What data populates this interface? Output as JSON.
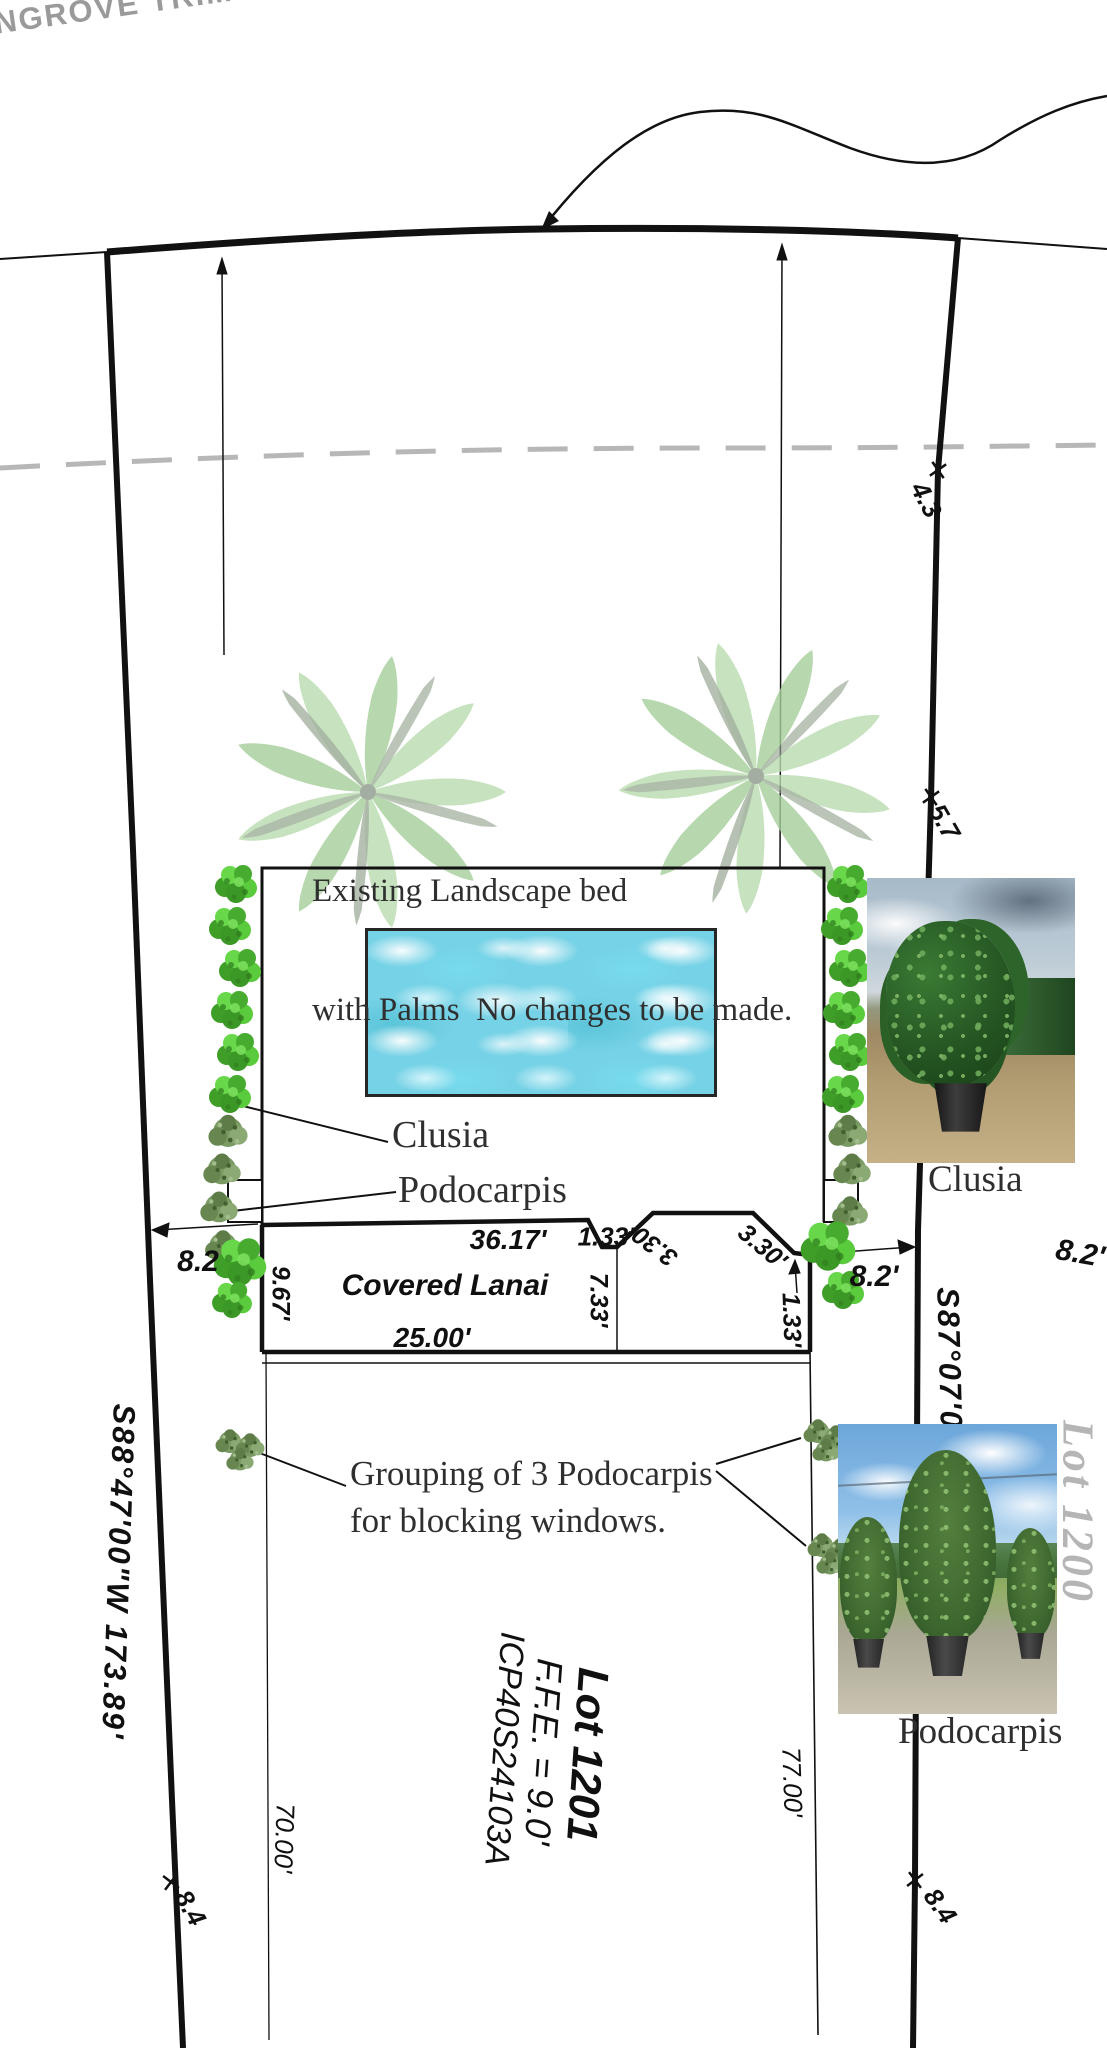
{
  "note": "NGROVE TRIMMING)",
  "annotations": {
    "bed1": "Existing Landscape bed",
    "bed2": "with Palms  No changes to be made.",
    "clusia": "Clusia",
    "podocarpis": "Podocarpis",
    "group1": "Grouping of 3 Podocarpis",
    "group2": "for blocking windows."
  },
  "photos": {
    "clusia_caption": "Clusia",
    "podocarpis_caption": "Podocarpis"
  },
  "survey": {
    "bearing_left": "S88°47'00\"W  173.89'",
    "bearing_right": "S87°07'00\"W",
    "lot_label": "Lot 1201",
    "ffe": "F.F.E. = 9.0'",
    "parcel": "ICP40S24103A",
    "adjacent_lot": "Lot 1200",
    "lanai": "Covered Lanai"
  },
  "dimensions": {
    "lanai_top": "36.17'",
    "step_top": "1.33'",
    "bay_left": "3.30'",
    "bay_right": "3.30'",
    "step_right": "1.33'",
    "lanai_bottom": "25.00'",
    "lanai_west": "9.67'",
    "lanai_east": "7.33'",
    "offset_left": "8.2",
    "offset_right": "8.2'",
    "offset_right_outer": "8.2'",
    "line_west": "70.00'",
    "line_east": "77.00'",
    "tick_top": "4.3",
    "tick_mid": "5.7",
    "tick_bottom_left": "8.4",
    "tick_bottom_right": "8.4"
  },
  "colors": {
    "clusia_green": "#4db433",
    "podocarpus_green": "#7a9a63",
    "palm_green": "#b9dcae",
    "pool_water": "#76d2e6",
    "dashed_line_gray": "#b7b7b7",
    "adjacent_lot_gray": "#b5b5b5",
    "note_gray": "#9a9a9a",
    "line_black": "#111111"
  }
}
